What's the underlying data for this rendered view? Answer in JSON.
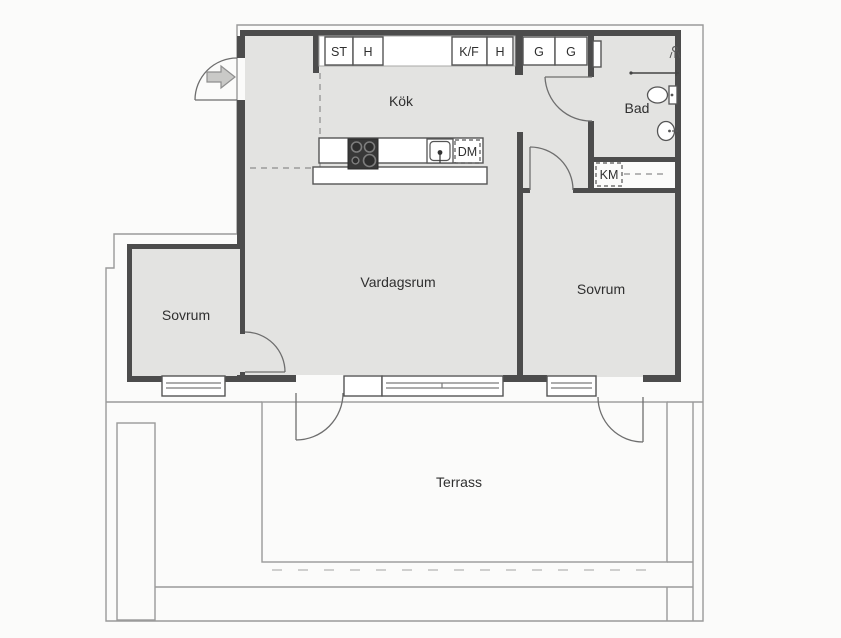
{
  "floor_plan": {
    "title": "Apartment floor plan with terrace",
    "language": "Swedish",
    "rooms": [
      {
        "key": "kok",
        "label": "Kök"
      },
      {
        "key": "bad",
        "label": "Bad"
      },
      {
        "key": "vardagsrum",
        "label": "Vardagsrum"
      },
      {
        "key": "sovrum_vaster",
        "label": "Sovrum"
      },
      {
        "key": "sovrum_oster",
        "label": "Sovrum"
      },
      {
        "key": "terrass",
        "label": "Terrass"
      }
    ],
    "kitchen": {
      "cabinets": [
        {
          "key": "st",
          "label": "ST"
        },
        {
          "key": "h1",
          "label": "H"
        },
        {
          "key": "kf",
          "label": "K/F"
        },
        {
          "key": "h2",
          "label": "H"
        }
      ],
      "dishwasher_label": "DM"
    },
    "hall": {
      "wardrobes": [
        {
          "key": "g1",
          "label": "G"
        },
        {
          "key": "g2",
          "label": "G"
        }
      ]
    },
    "laundry": {
      "washer_label": "KM"
    },
    "icons": {
      "entrance": "arrow-right-icon",
      "bathroom": [
        "shower-icon",
        "toilet-icon",
        "washbasin-icon"
      ],
      "kitchen": [
        "stove-icon",
        "kitchen-sink-icon"
      ]
    },
    "colors": {
      "background": "#fbfbfa",
      "floor_fill": "#e3e3e1",
      "wall": "#4c4c4c",
      "thin_line": "#9a9a9a",
      "stove": "#383838",
      "text": "#2f2f2f"
    }
  }
}
